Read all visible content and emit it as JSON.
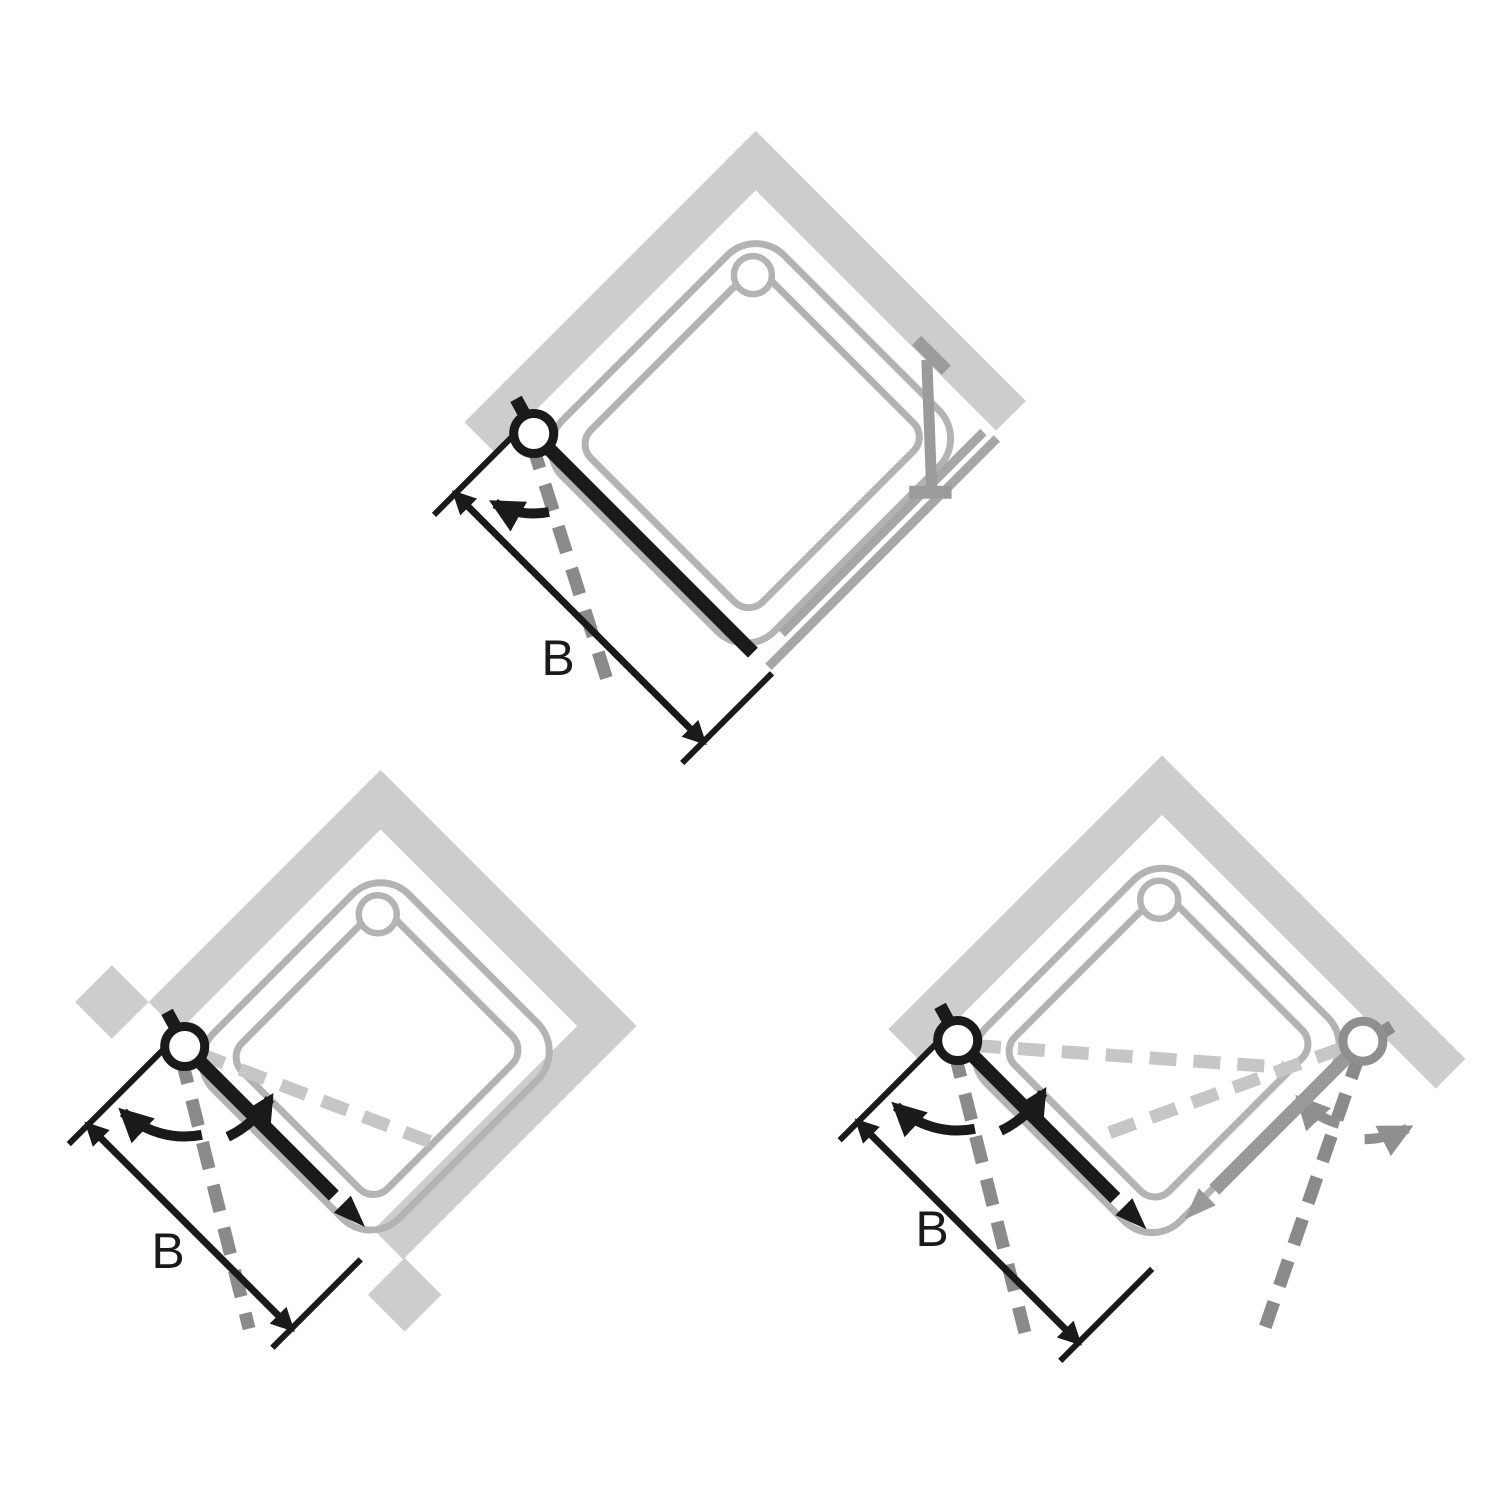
{
  "page": {
    "background": "#ffffff",
    "description_visible_text_only": true
  },
  "colors": {
    "wall": "#cdcdcd",
    "tray_outline": "#b3b3b3",
    "side_panel": "#a6a6a6",
    "stabilizer_bar": "#9b9b9b",
    "door_black": "#1a1a1a",
    "door_gray": "#999999",
    "swing_dash_outward": "#8a8a8a",
    "swing_dash_inward": "#c6c6c6",
    "swing_arrow_gray": "#8f8f8f",
    "dimension": "#1a1a1a"
  },
  "diagrams": [
    {
      "position": "top-center",
      "type": "pivot-door-with-fixed-side-panel",
      "width_label": "B"
    },
    {
      "position": "bottom-left",
      "type": "niche-pivot-door-opens-both-ways",
      "width_label": "B"
    },
    {
      "position": "bottom-right",
      "type": "corner-entry-two-pivot-doors",
      "width_label": "B"
    }
  ]
}
